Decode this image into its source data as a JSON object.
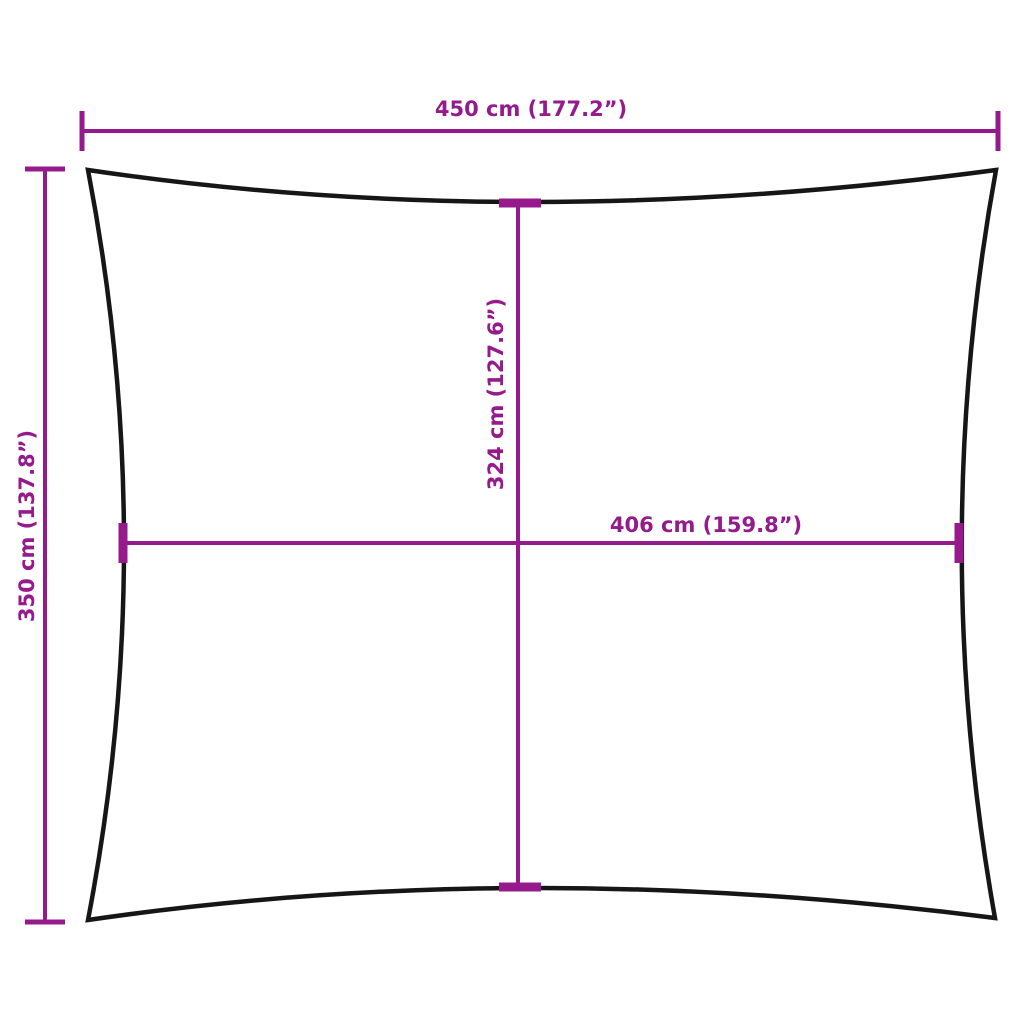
{
  "diagram": {
    "labels": {
      "top_width": "450 cm (177.2”)",
      "left_height": "350 cm (137.8”)",
      "inner_height": "324 cm (127.6”)",
      "inner_width": "406 cm (159.8”)"
    },
    "colors": {
      "dimension": "#951B8C",
      "outline": "#161616",
      "background": "#FFFFFF"
    }
  }
}
